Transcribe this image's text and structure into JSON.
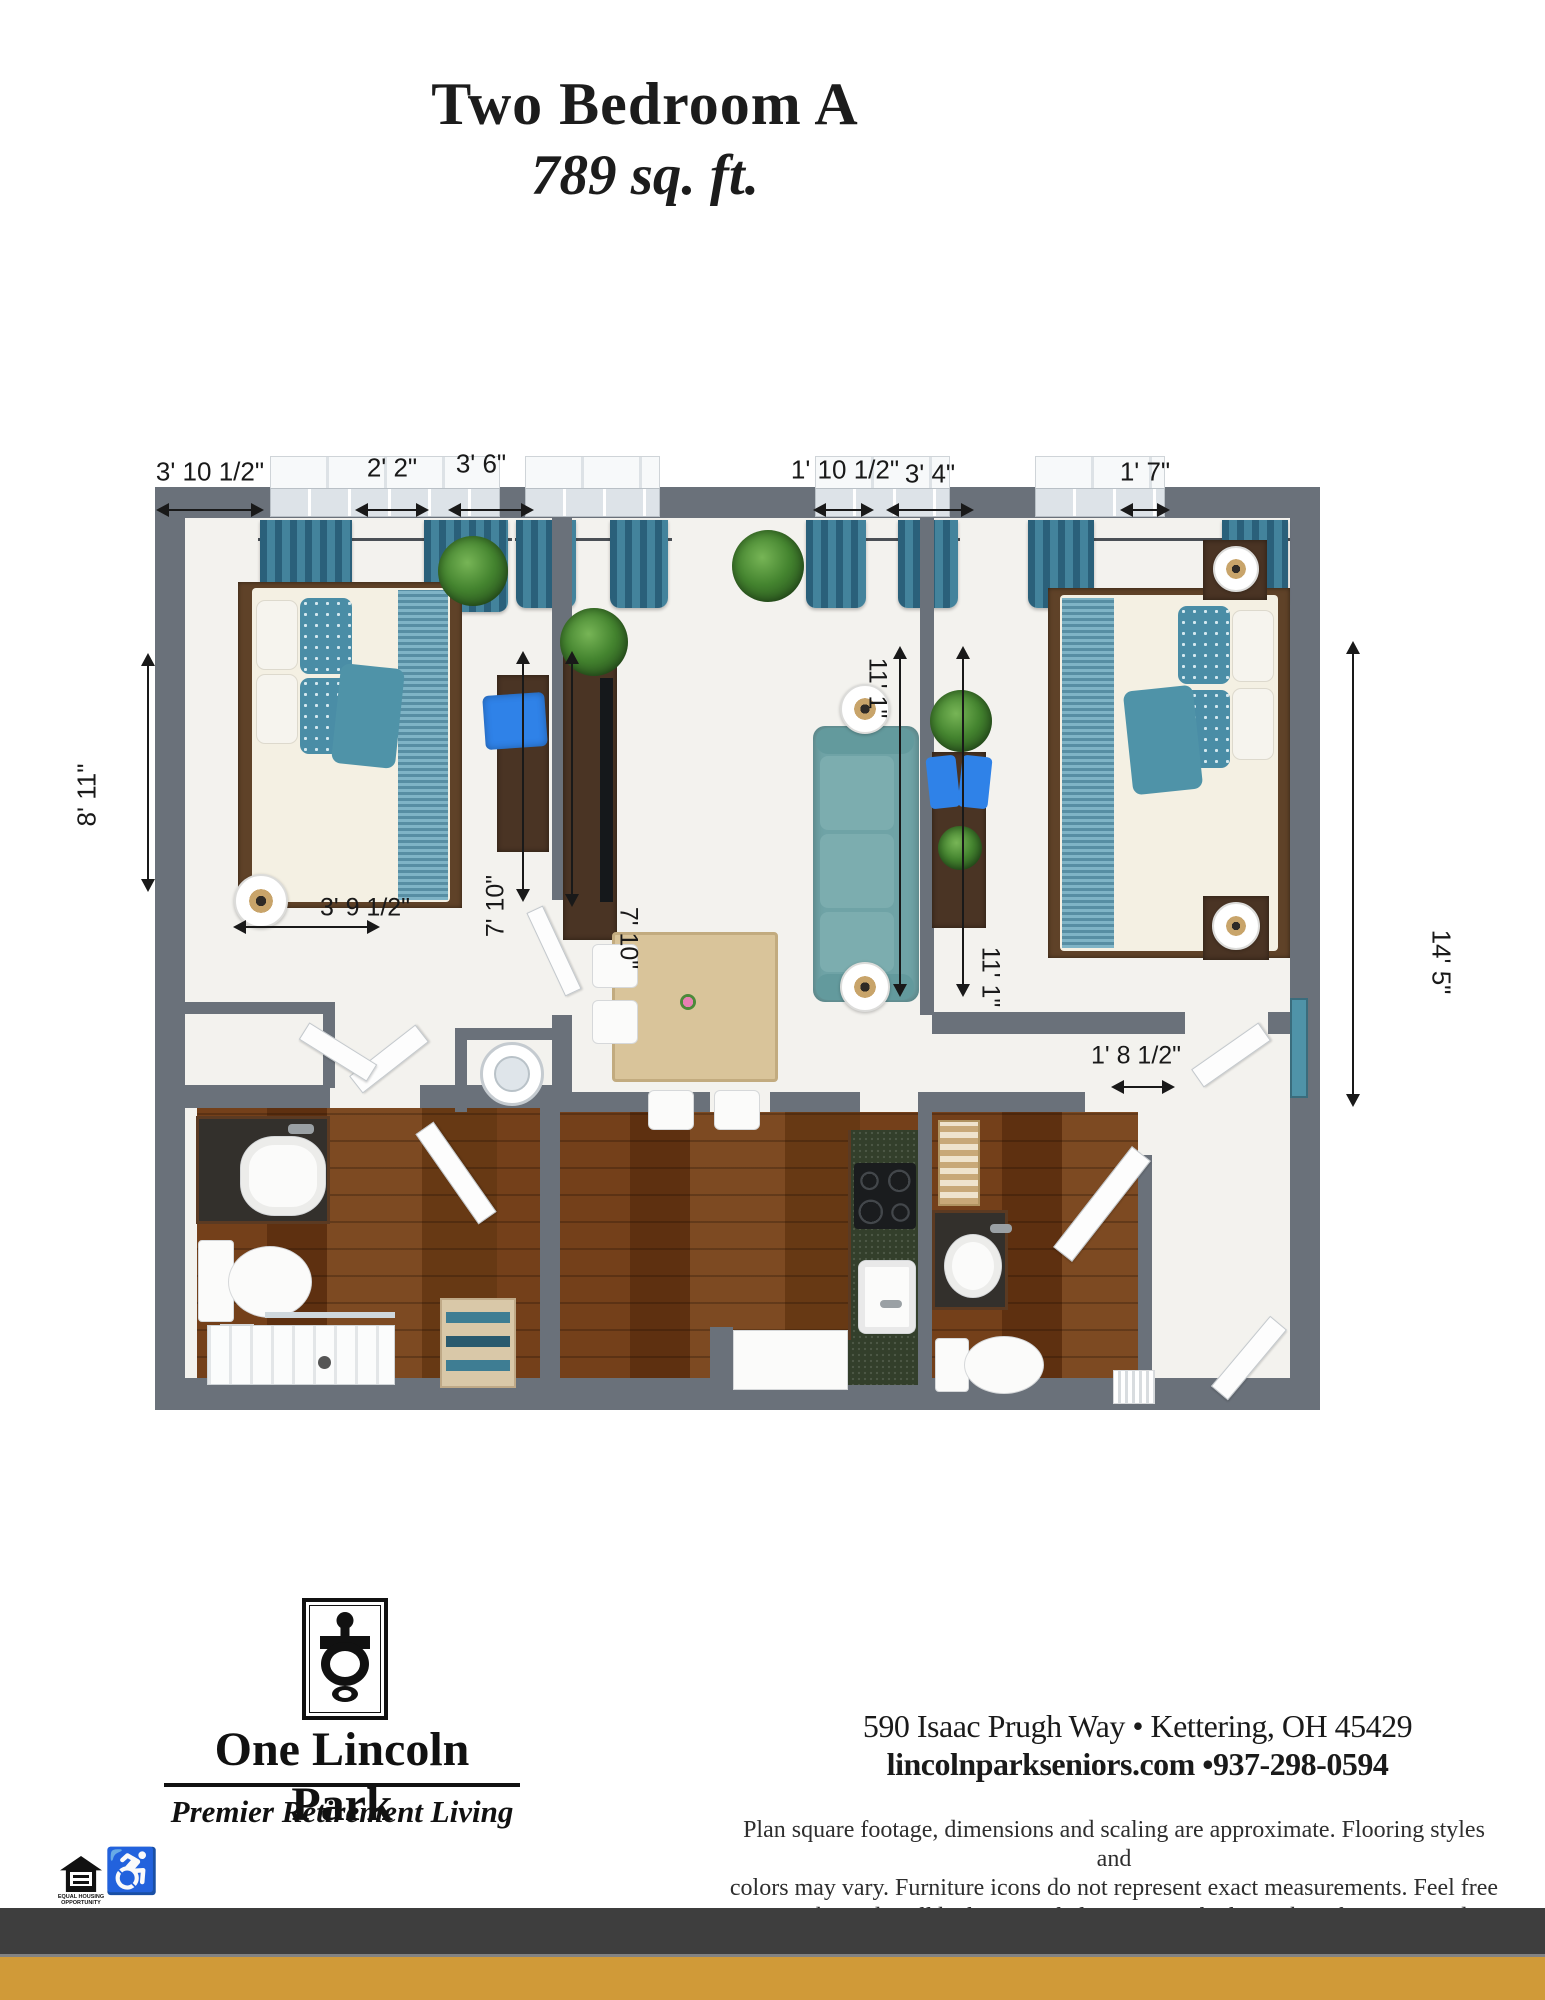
{
  "title": {
    "line1": "Two Bedroom A",
    "line2": "789 sq. ft."
  },
  "dimensions": {
    "top": [
      {
        "label": "3' 10 1/2\""
      },
      {
        "label": "2' 2\""
      },
      {
        "label": "3' 6\""
      },
      {
        "label": "1' 10 1/2\""
      },
      {
        "label": "3' 4\""
      },
      {
        "label": "1' 7\""
      }
    ],
    "left": {
      "label": "8' 11\""
    },
    "right": {
      "label": "14' 5\""
    },
    "interior": [
      {
        "label": "3' 9 1/2\""
      },
      {
        "label": "7' 10\""
      },
      {
        "label": "7' 10\""
      },
      {
        "label": "11' 1\""
      },
      {
        "label": "11' 1\""
      },
      {
        "label": "1' 8 1/2\""
      }
    ]
  },
  "footer": {
    "logo": {
      "name": "One Lincoln Park",
      "tagline": "Premier Retirement Living",
      "emblem": "door-knocker"
    },
    "address": "590 Isaac Prugh Way • Kettering, OH 45429",
    "contact": "lincolnparkseniors.com •937-298-0594",
    "disclaimer_line1": "Plan square footage, dimensions and scaling are approximate. Flooring styles and",
    "disclaimer_line2": "colors may vary. Furniture icons do not represent exact measurements. Feel free",
    "disclaimer_line3": "to stop by and we'll be happy to help you see which unit best fits your needs.",
    "equal_housing_caption": "EQUAL HOUSING OPPORTUNITY",
    "wheelchair_glyph": "♿"
  },
  "colors": {
    "wall_gray": "#6A717A",
    "accent_teal": "#47808F",
    "brand_gold": "#D09A38",
    "footer_dark": "#3E3E3E",
    "wood_brown": "#6E3E1F",
    "counter_green": "#333F2B",
    "chair_blue": "#2F82E8"
  }
}
